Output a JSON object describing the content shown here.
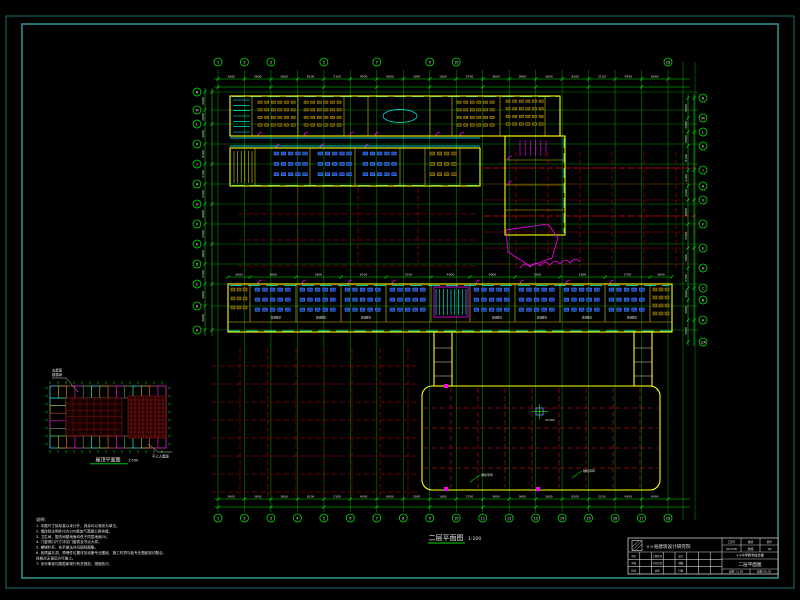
{
  "colors": {
    "frame": "#2f8f8f",
    "grid_green": "#00a400",
    "bright_green": "#00e000",
    "dim_red": "#8a0000",
    "bright_red": "#cc1010",
    "wall_yellow": "#ffff00",
    "window_cyan": "#00ffff",
    "desk_blue": "#2343c2",
    "magenta": "#ff00ff",
    "text_white": "#e8e8e8"
  },
  "axes": {
    "bottom": [
      "1",
      "2",
      "3",
      "4",
      "5",
      "6",
      "7",
      "8",
      "9",
      "10",
      "11",
      "12",
      "13",
      "14",
      "15",
      "16",
      "17",
      "18"
    ],
    "top_idx": [
      0,
      1,
      2,
      4,
      6,
      8,
      9,
      17
    ],
    "left": [
      "N",
      "M",
      "L",
      "K",
      "J",
      "H",
      "G",
      "F",
      "E",
      "D",
      "C",
      "B",
      "A"
    ],
    "right": [
      "N",
      "M",
      "L",
      "K",
      "J",
      "H",
      "G",
      "F",
      "E",
      "D",
      "C",
      "B",
      "A",
      "1/A"
    ]
  },
  "dims": {
    "values": [
      "3600",
      "3600",
      "3600",
      "8100",
      "2100",
      "4500",
      "6900",
      "3300",
      "1800",
      "2700"
    ]
  },
  "main_plan_title": {
    "text": "二层平面图",
    "scale": "1:100"
  },
  "room_label": "普通教室",
  "playground": {
    "leader_a": "绿化草坪",
    "leader_b": "绿化草坪",
    "center_mark": "±0.000"
  },
  "small_plan": {
    "title": "屋顶平面图",
    "scale": "1:500",
    "leader_top_line1": "出屋面",
    "leader_top_line2": "楼梯间",
    "leader_bottom": "不上人屋面"
  },
  "notes": {
    "header": "说明:",
    "lines": [
      "1. 本图尺寸除标高以米计外，其余均以毫米为单位。",
      "2. 墙体除注明外均为200厚加气混凝土砌块墙。",
      "3. 卫生间、盥洗间楼地面均低于同层地面20。",
      "4. 门窗洞口尺寸详见门窗表及节点大样。",
      "5. 楼梯栏杆、扶手做法详见国标图集。",
      "6. 各预留孔洞、预埋件位置详见设备专业图纸，施工时须与各专业图纸密切配合，",
      "    经核对无误后方可施工。",
      "7. 未尽事宜均按国家现行有关规范、规程执行。"
    ]
  },
  "title_block": {
    "company": "××省建筑设计研究院",
    "sig_labels_row1": [
      "审定",
      "工程负责",
      "设计"
    ],
    "sig_labels_row2": [
      "审核",
      "专业负责",
      "制图"
    ],
    "sig_labels_row3": [
      "校对",
      "会签",
      "日期"
    ],
    "fields_row1": [
      "工程号",
      "图别",
      "图号"
    ],
    "fields_row2": [
      "06-038",
      "建施",
      "09"
    ],
    "project": "××中学教学综合楼",
    "drawing": "二层平面图",
    "scale_label": "比例",
    "scale": "1:100",
    "date_label": "日期",
    "date": "06.05"
  }
}
